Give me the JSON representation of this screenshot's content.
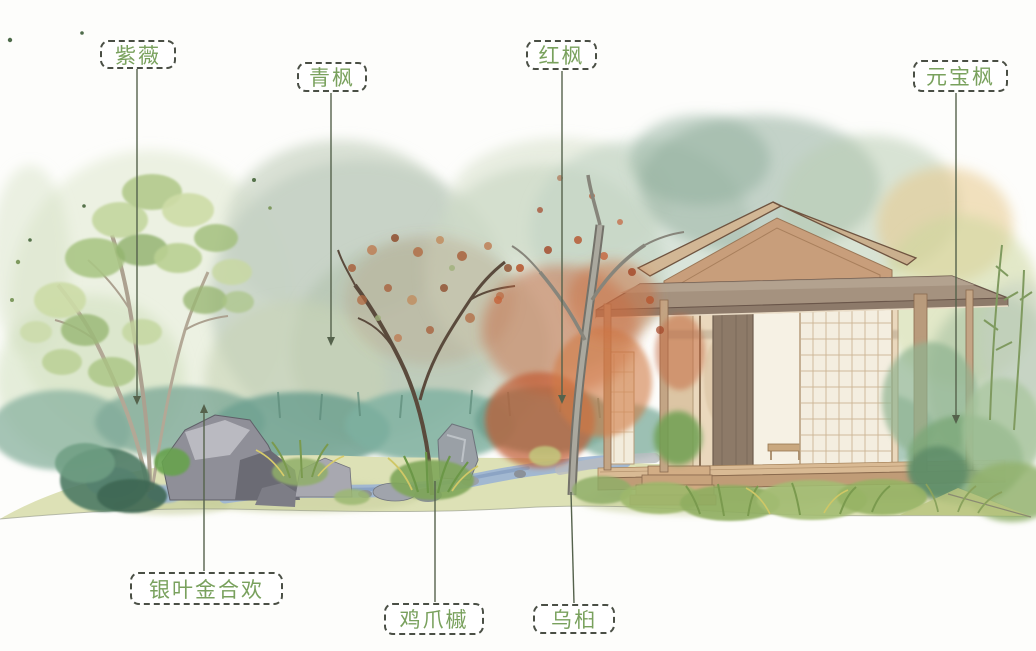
{
  "labels": [
    {
      "id": "ziwei",
      "text": "紫薇"
    },
    {
      "id": "qingfeng",
      "text": "青枫"
    },
    {
      "id": "hongfeng",
      "text": "红枫"
    },
    {
      "id": "yuanbaofeng",
      "text": "元宝枫"
    },
    {
      "id": "yinyejinhehuan",
      "text": "银叶金合欢"
    },
    {
      "id": "jizhuaqi",
      "text": "鸡爪槭"
    },
    {
      "id": "wujiu",
      "text": "乌桕"
    }
  ],
  "scene": {
    "elements": [
      "tea-house",
      "stream",
      "rocks",
      "crape-myrtle-tree",
      "japanese-maple-tree",
      "red-maple-foliage",
      "tallow-tree",
      "ground",
      "foreground-grasses",
      "background-foliage"
    ]
  },
  "colors": {
    "label_text": "#79a15d",
    "label_border": "#4a4f45",
    "leader_line": "#55624c",
    "background": "#fdfdfb",
    "red_maple": "#c4633a",
    "roof": "#a5927f",
    "wall": "#ead8bd",
    "stream": "#9cb4d4",
    "ground": "#dde1b6"
  }
}
